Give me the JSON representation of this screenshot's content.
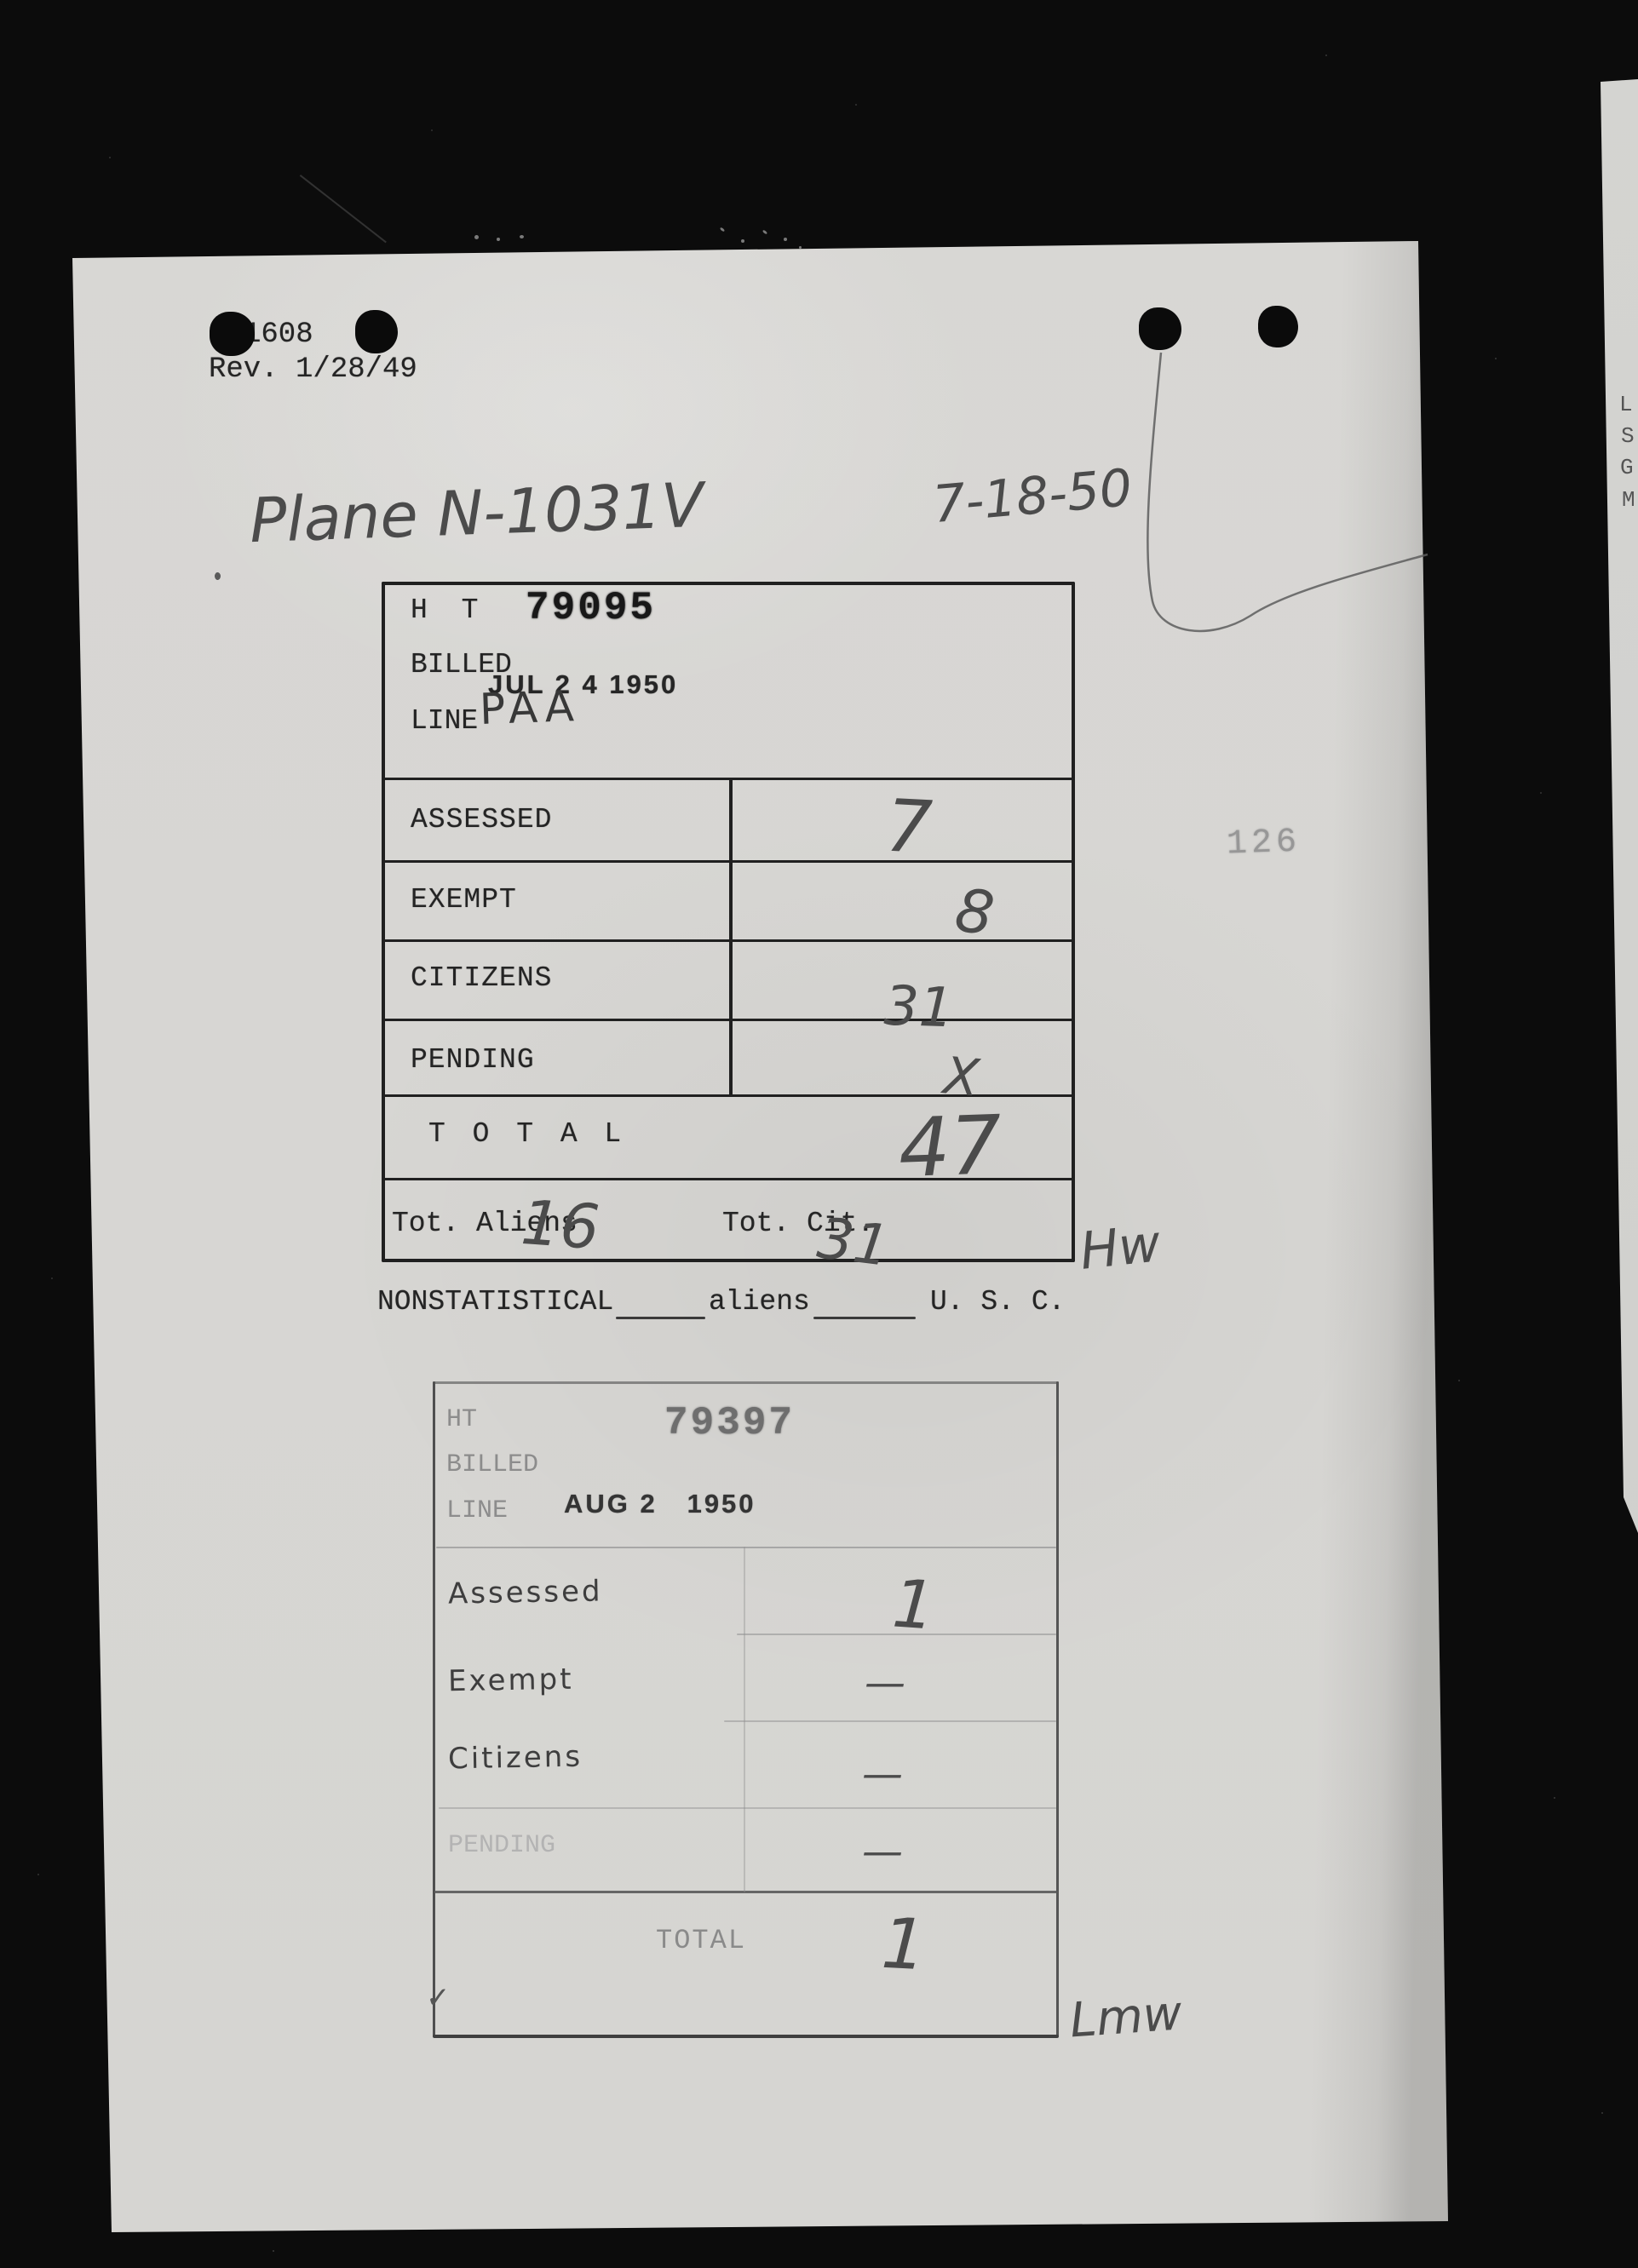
{
  "doc": {
    "form_number": "1608",
    "revision": "Rev. 1/28/49",
    "plane_title": "Plane N-1031V",
    "date_note": "7-18-50",
    "page_stamp": "126",
    "nonstat": {
      "label": "NONSTATISTICAL",
      "aliens": "aliens",
      "usc": "U. S. C."
    },
    "strip_letters": [
      "L",
      "S",
      "G",
      "M"
    ]
  },
  "card1": {
    "ht_label": "H T",
    "ht_number": "79095",
    "billed_label": "BILLED",
    "billed_stamp": "JUL 2 4 1950",
    "line_label": "LINE",
    "line_value": "PAA",
    "rows": [
      {
        "label": "ASSESSED",
        "value": "7"
      },
      {
        "label": "EXEMPT",
        "value": "8"
      },
      {
        "label": "CITIZENS",
        "value": "31"
      },
      {
        "label": "PENDING",
        "value": "X"
      }
    ],
    "total_label": "T O T A L",
    "total_value": "47",
    "tot_aliens_label": "Tot. Aliens",
    "tot_aliens_value": "16",
    "tot_cit_label": "Tot. Cit.",
    "tot_cit_value": "31",
    "initials": "Hw"
  },
  "card2": {
    "ht_label": "HT",
    "ht_number": "79397",
    "billed_label": "BILLED",
    "line_label": "LINE",
    "date_stamp": "AUG 2   1950",
    "rows": [
      {
        "label": "Assessed",
        "value": "1"
      },
      {
        "label": "Exempt",
        "value": "—"
      },
      {
        "label": "Citizens",
        "value": "—"
      },
      {
        "label": "PENDING",
        "value": "—"
      }
    ],
    "total_label": "TOTAL",
    "total_value": "1",
    "checkmark": "✓",
    "initials": "Lmw"
  }
}
